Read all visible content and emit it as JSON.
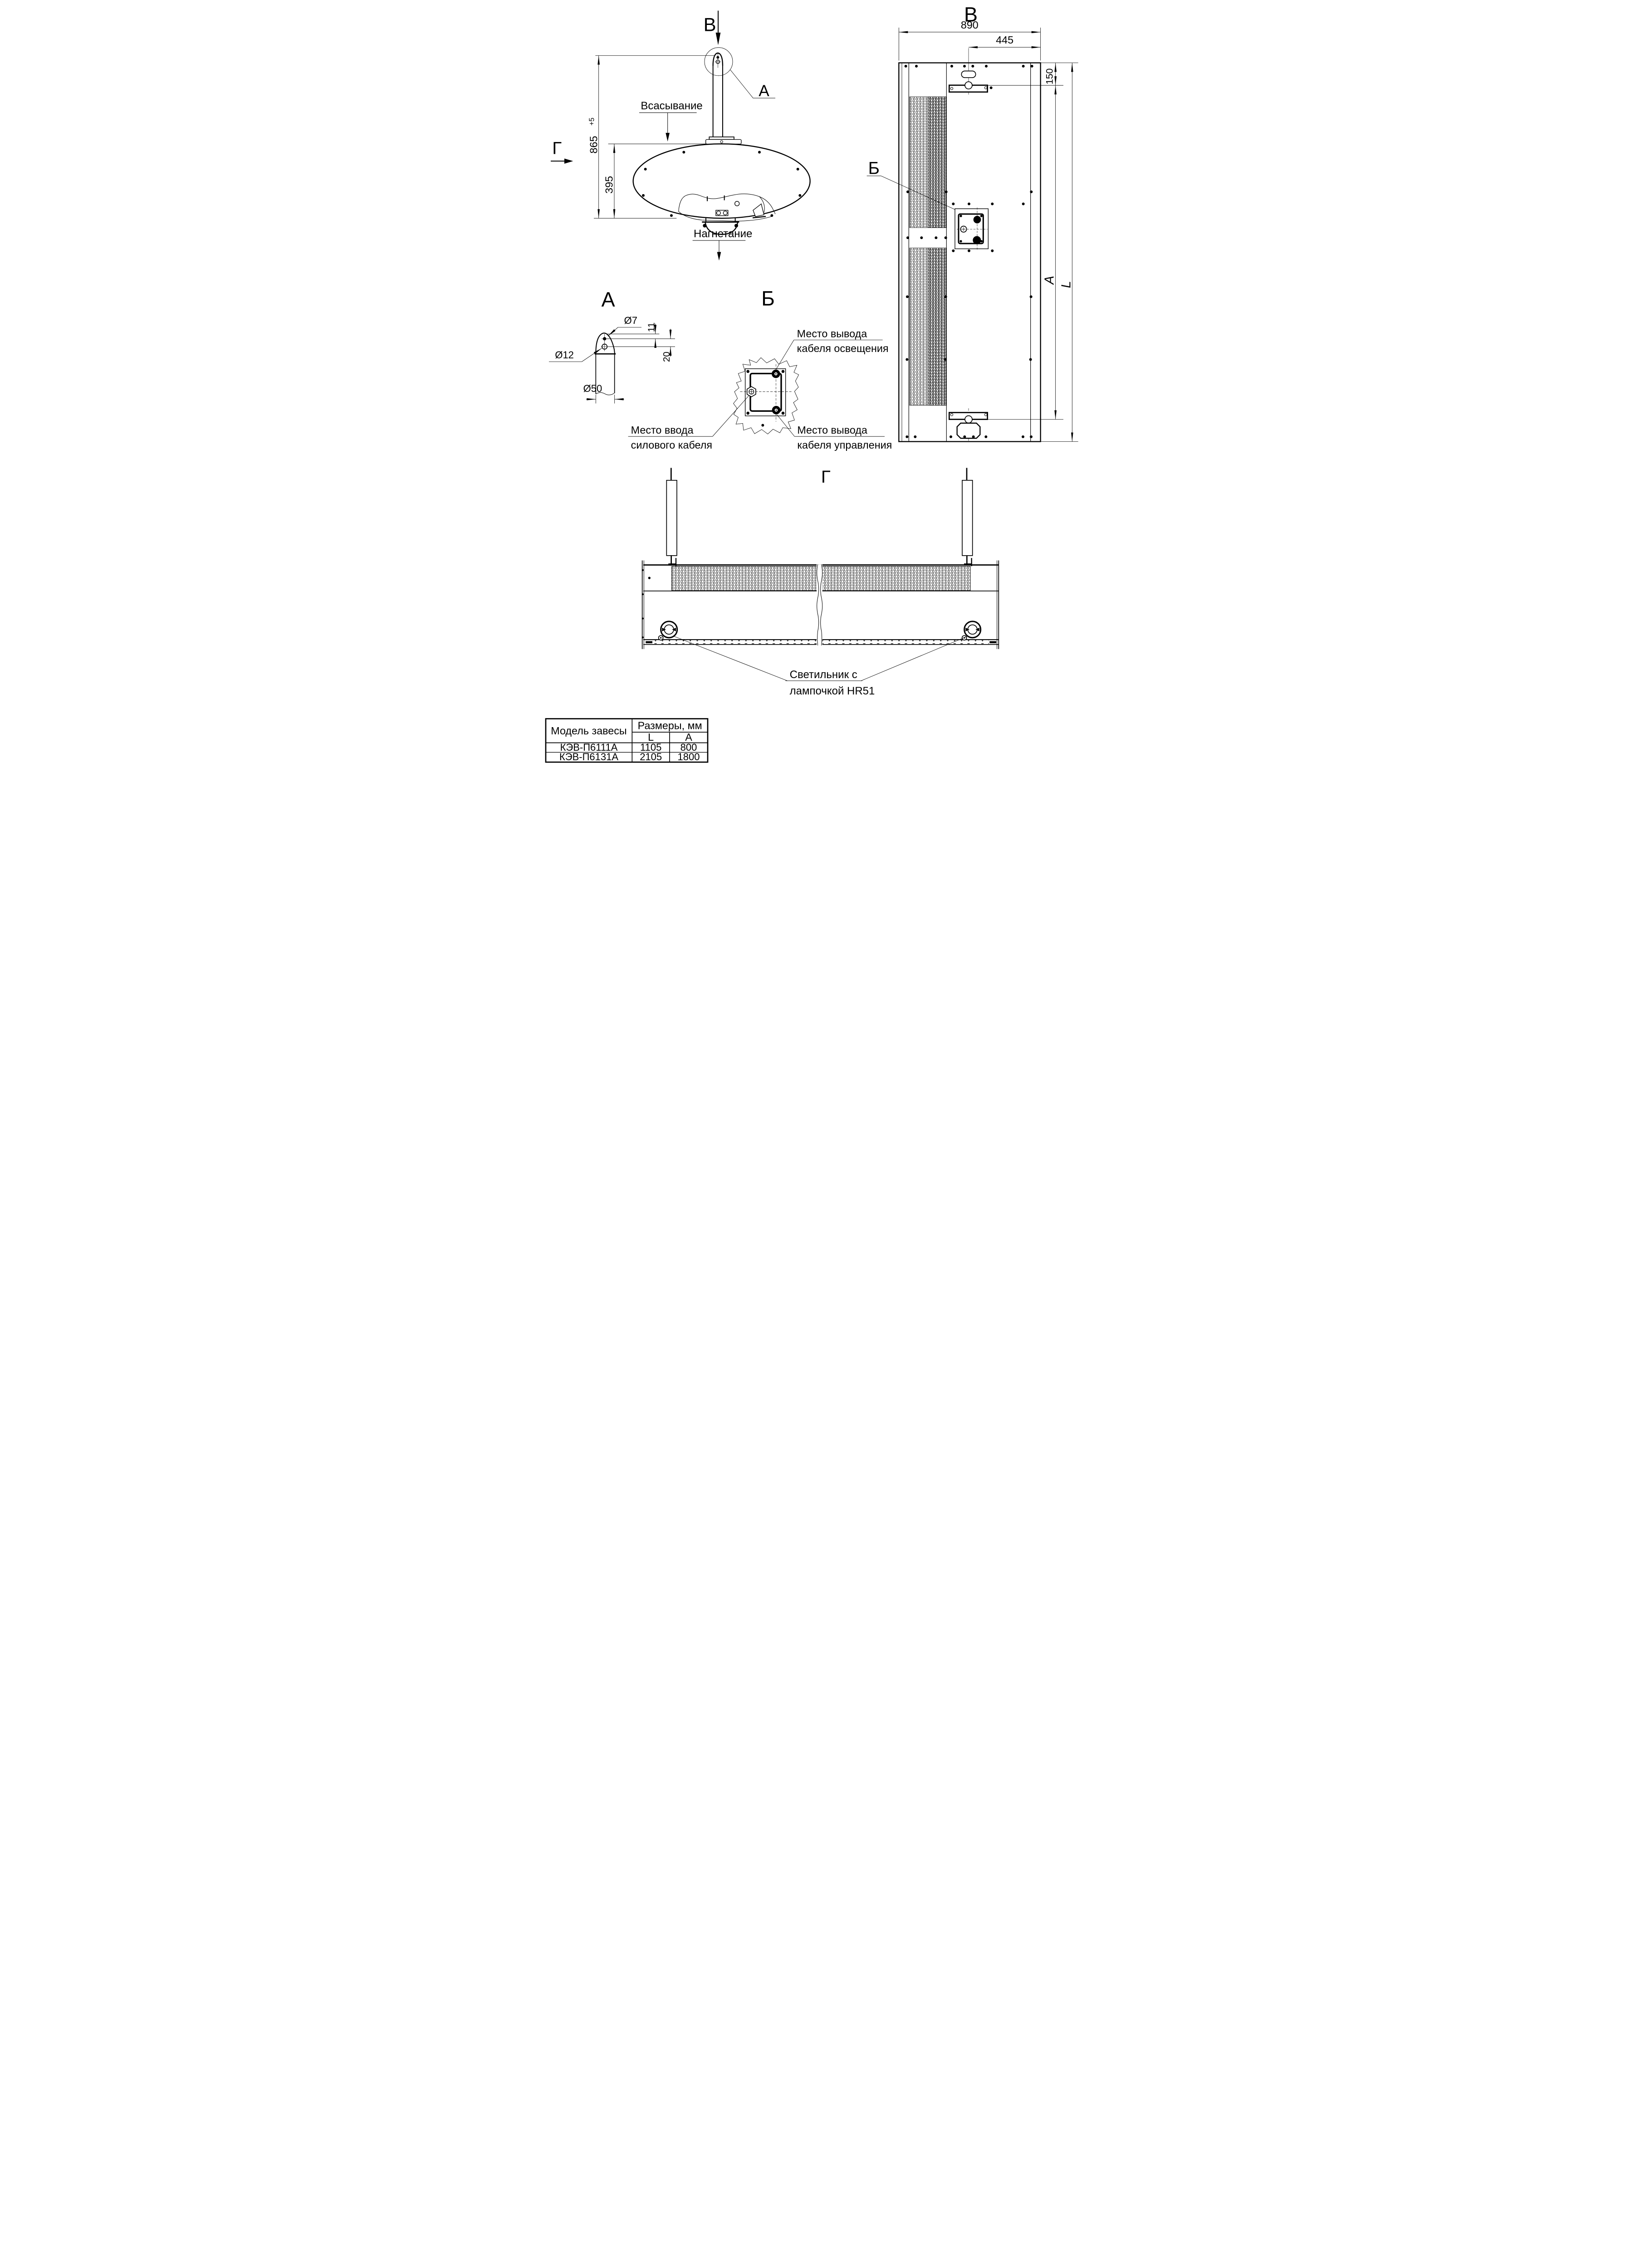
{
  "drawing": {
    "side_view": {
      "view_letter_top": "В",
      "view_letter_left": "Г",
      "detail_callout": "А",
      "suction_label": "Всасывание",
      "discharge_label": "Нагнетание",
      "dim_height_total": "865",
      "dim_height_tolerance": "+5",
      "dim_body_height": "395"
    },
    "front_view": {
      "title": "В",
      "junction_callout": "Б",
      "dim_width": "890",
      "dim_bracket_offset": "445",
      "dim_bracket_top": "150",
      "dim_mount_span": "A",
      "dim_total_length": "L"
    },
    "detail_a": {
      "title": "А",
      "dim_hole_small": "Ø7",
      "dim_hole_large": "Ø12",
      "dim_post_diameter": "Ø50",
      "dim_hole_offset": "11",
      "dim_hole_spacing": "20"
    },
    "detail_b": {
      "title": "Б",
      "lighting_cable_line1": "Место вывода",
      "lighting_cable_line2": "кабеля освещения",
      "power_cable_line1": "Место ввода",
      "power_cable_line2": "силового кабеля",
      "control_cable_line1": "Место вывода",
      "control_cable_line2": "кабеля управления"
    },
    "bottom_view": {
      "title": "Г",
      "lamp_label_line1": "Светильник с",
      "lamp_label_line2": "лампочкой HR51"
    },
    "table": {
      "col_model": "Модель завесы",
      "col_dimensions": "Размеры, мм",
      "col_l": "L",
      "col_a": "A",
      "rows": [
        {
          "model": "КЭВ-П6111А",
          "l": "1105",
          "a": "800"
        },
        {
          "model": "КЭВ-П6131А",
          "l": "2105",
          "a": "1800"
        }
      ]
    },
    "colors": {
      "line": "#000000",
      "background": "#ffffff"
    }
  }
}
